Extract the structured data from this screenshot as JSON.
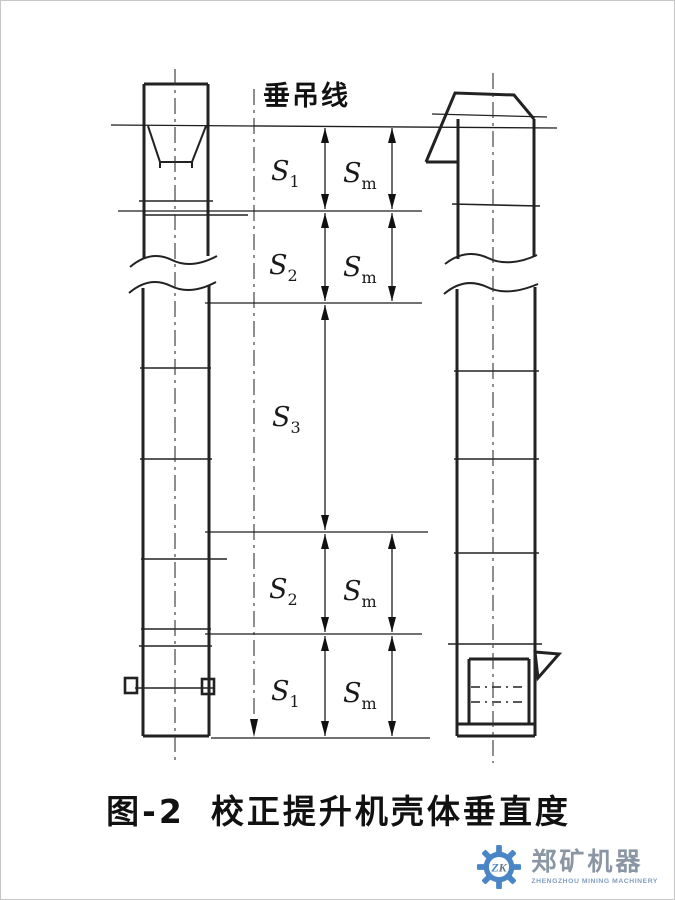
{
  "figure": {
    "plumb_label": "垂吊线",
    "caption": {
      "number": "图-2",
      "title": "校正提升机壳体垂直度"
    },
    "labels": {
      "row1_left": {
        "base": "S",
        "sub": "1"
      },
      "row1_right": {
        "base": "S",
        "sub": "m"
      },
      "row2_left": {
        "base": "S",
        "sub": "2"
      },
      "row2_right": {
        "base": "S",
        "sub": "m"
      },
      "row3": {
        "base": "S",
        "sub": "3"
      },
      "row4_left": {
        "base": "S",
        "sub": "2"
      },
      "row4_right": {
        "base": "S",
        "sub": "m"
      },
      "row5_left": {
        "base": "S",
        "sub": "1"
      },
      "row5_right": {
        "base": "S",
        "sub": "m"
      }
    }
  },
  "logo": {
    "monogram": {
      "z": "Z",
      "k": "K"
    },
    "company_name": "郑矿机器",
    "company_subtitle": "ZHENGZHOU MINING MACHINERY",
    "colors": {
      "gear": "#4a86c5",
      "name": "#8a96a3",
      "subtitle": "#7f9fc0"
    }
  },
  "colors": {
    "ink": "#222222",
    "background": "#ffffff"
  }
}
